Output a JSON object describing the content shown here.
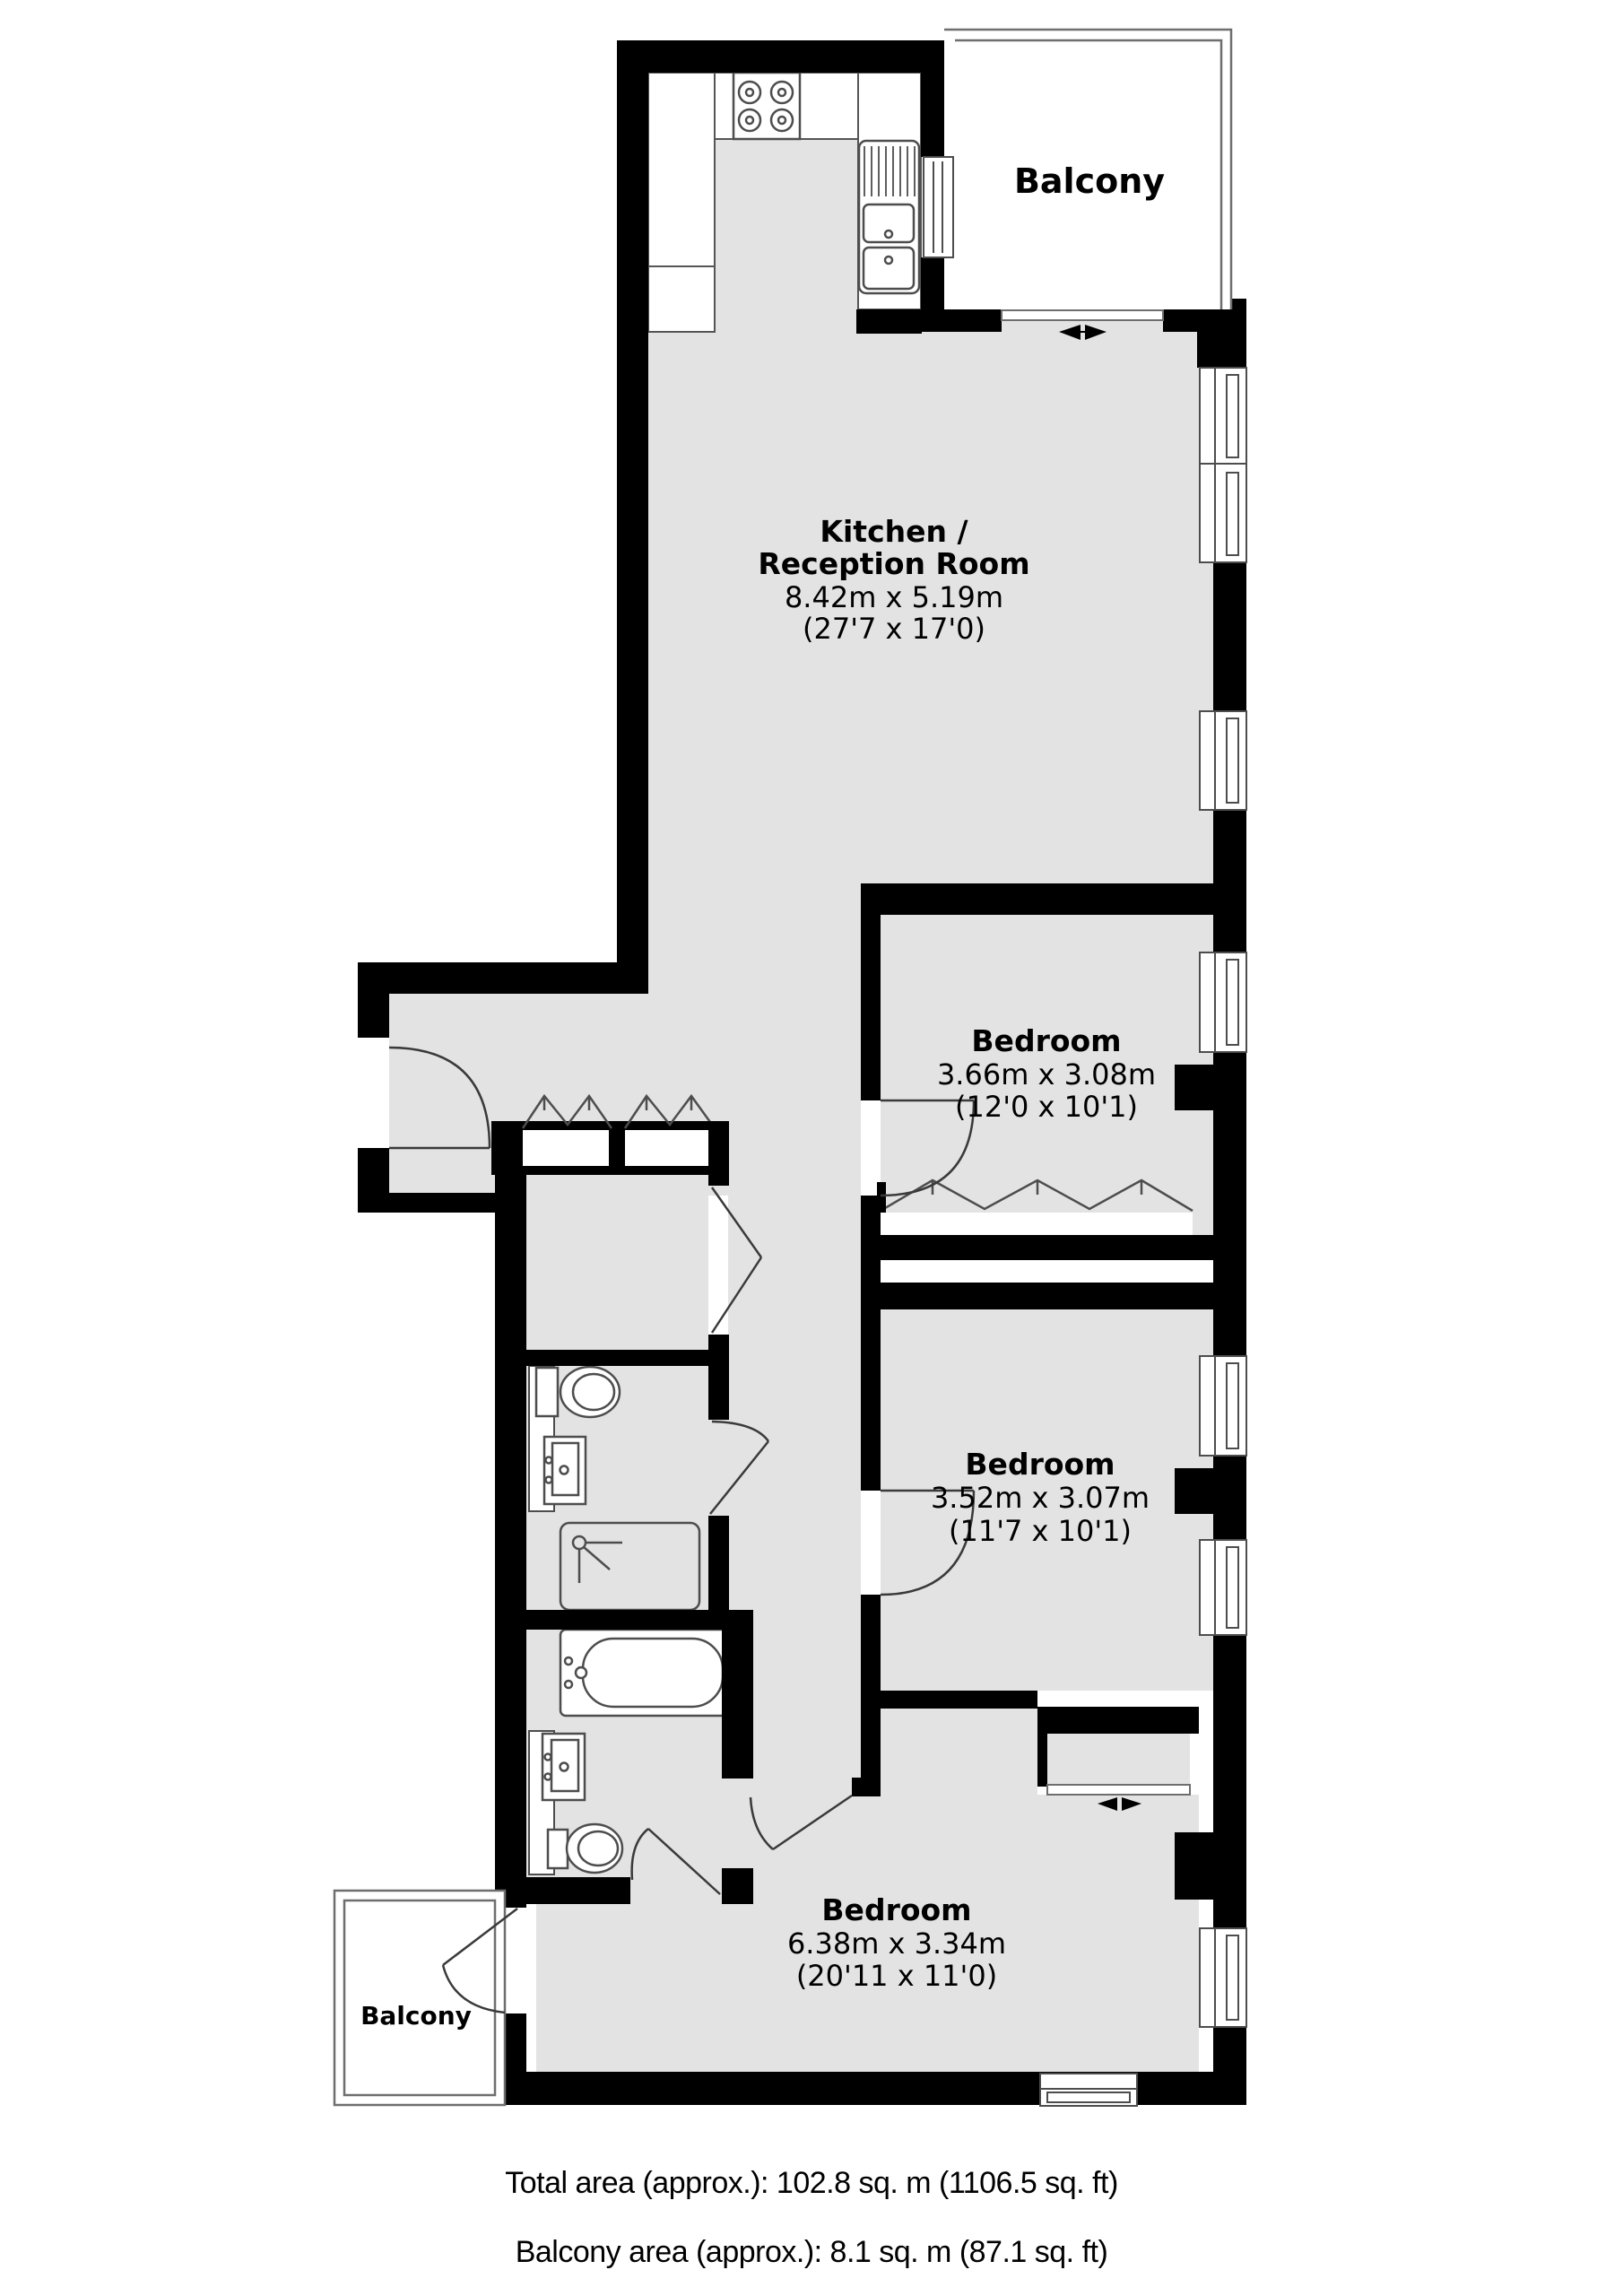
{
  "plan": {
    "type": "apartment-floor-plan",
    "colors": {
      "wall": "#000000",
      "floor": "#e3e3e3",
      "fixture_stroke": "#4d4d4d",
      "door_stroke": "#3a3a3a",
      "balcony_stroke": "#6e6e6e",
      "text": "#000000",
      "background": "#ffffff"
    },
    "rooms": {
      "kitchen_reception": {
        "name_line1": "Kitchen /",
        "name_line2": "Reception Room",
        "dim_metric": "8.42m x 5.19m",
        "dim_imperial": "(27'7 x 17'0)"
      },
      "bedroom1": {
        "name": "Bedroom",
        "dim_metric": "3.66m x 3.08m",
        "dim_imperial": "(12'0 x 10'1)"
      },
      "bedroom2": {
        "name": "Bedroom",
        "dim_metric": "3.52m x 3.07m",
        "dim_imperial": "(11'7 x 10'1)"
      },
      "bedroom3": {
        "name": "Bedroom",
        "dim_metric": "6.38m x 3.34m",
        "dim_imperial": "(20'11 x 11'0)"
      },
      "balcony_top": {
        "name": "Balcony"
      },
      "balcony_bottom": {
        "name": "Balcony"
      }
    },
    "fixtures": [
      "hob-icon",
      "sink-double-icon",
      "toilet-icon",
      "washbasin-icon",
      "shower-icon",
      "bathtub-icon",
      "sliding-door-arrows-icon",
      "door-swing-icon",
      "window-icon",
      "bifold-closet-icon",
      "wardrobe-icon"
    ],
    "footer": {
      "total_area": "Total area (approx.): 102.8 sq. m (1106.5 sq. ft)",
      "balcony_area": "Balcony area (approx.): 8.1 sq. m (87.1 sq. ft)"
    }
  }
}
